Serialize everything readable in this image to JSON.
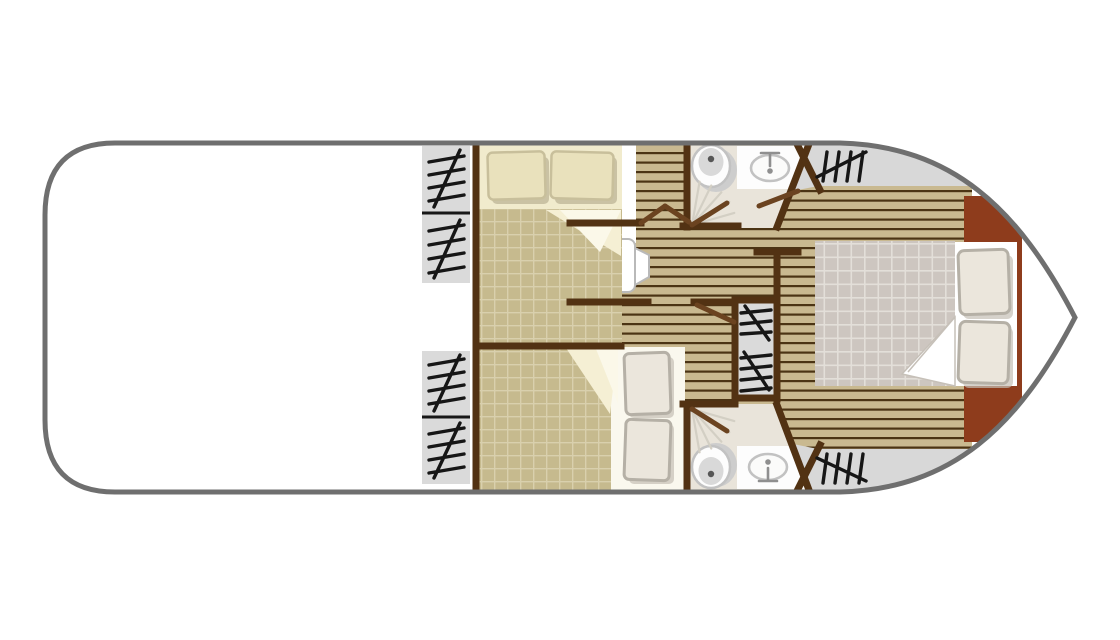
{
  "meta": {
    "label": "Houseboat deck floor plan",
    "type": "floor-plan"
  },
  "palette": {
    "page_bg": "#ffffff",
    "hull_line": "#6f6f6f",
    "deck": "#ffffff",
    "steps_bg": "#dadada",
    "bow_deck": "#d8d8d8",
    "hatch": "#161616",
    "wall": "#523213",
    "door": "#6b4320",
    "plank_base": "#c9b990",
    "plank_line": "#4b3414",
    "quilt_khaki": "#c6ba8e",
    "quilt_khaki_grid": "#d9d0ad",
    "sheet_cream": "#f1ebcd",
    "fold_cream": "#f5efd4",
    "fold_light": "#fbf8e9",
    "pillow_cream": "#e9e1bc",
    "pillow_cream_edge": "#c8bf9b",
    "pillow_shadow": "#aaa183",
    "sheet_white": "#faf8ee",
    "bed_white": "#ffffff",
    "quilt_master": "#cdc6c0",
    "quilt_master_grid": "#e3dfd9",
    "pillow_gray": "#ebe6dc",
    "pillow_gray_edge": "#b5b0a6",
    "headboard": "#8e3c1c",
    "bath_floor": "#e9e4da",
    "fixture_fill": "#fdfdfd",
    "fixture_stroke": "#c2c2c2",
    "fixture_inner": "#d9d9d9",
    "fixture_dot": "#565656",
    "tap": "#8f8f8f",
    "fan_line": "#d3cfc4",
    "seat_fill": "#ffffff",
    "seat_stroke": "#b9b9b9"
  },
  "elements": {
    "icons": [
      "stairs-hatch-icon",
      "toilet-icon",
      "washbasin-icon",
      "tap-icon",
      "shower-door-icon"
    ],
    "features": [
      "aft-deck",
      "side-steps",
      "port-cabin",
      "starboard-cabin",
      "bathroom-fore",
      "bathroom-aft",
      "companionway-stairs",
      "corridor",
      "bow-master-cabin",
      "double-bed",
      "headboard"
    ]
  }
}
